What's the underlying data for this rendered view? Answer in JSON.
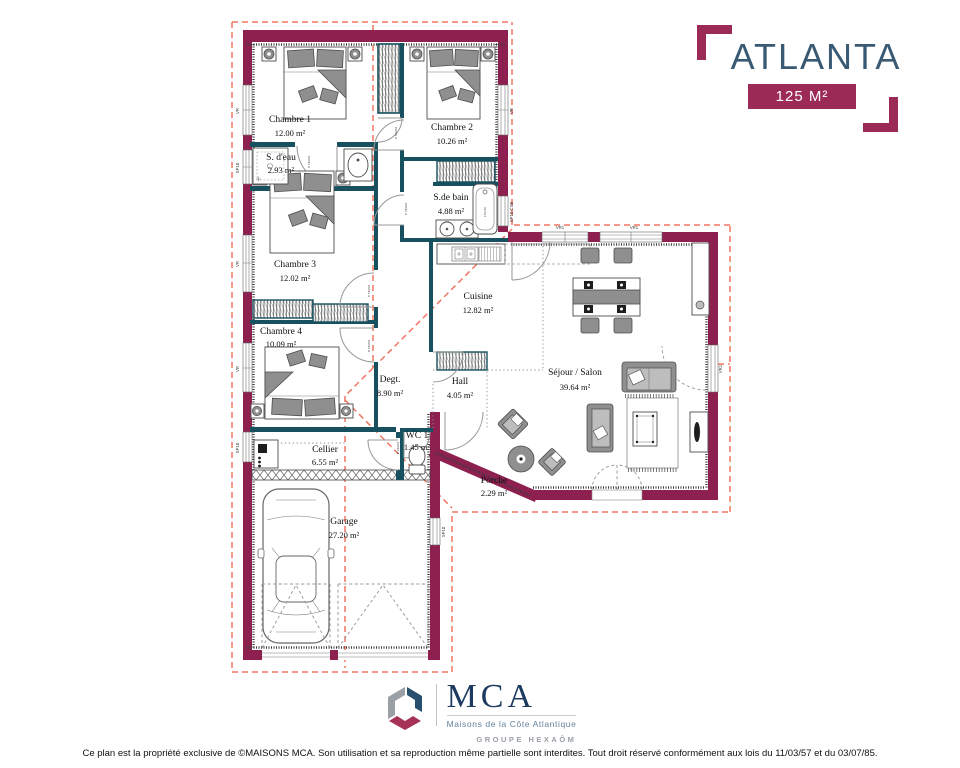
{
  "header": {
    "title": "ATLANTA",
    "area_badge": "125 M²"
  },
  "rooms": [
    {
      "name": "Chambre 1",
      "area": "12.00 m²"
    },
    {
      "name": "Chambre 2",
      "area": "10.26 m²"
    },
    {
      "name": "S. d'eau",
      "area": "2.93 m²"
    },
    {
      "name": "S.de bain",
      "area": "4.88 m²"
    },
    {
      "name": "Chambre 3",
      "area": "12.02 m²"
    },
    {
      "name": "Chambre 4",
      "area": "10.09 m²"
    },
    {
      "name": "Cuisine",
      "area": "12.82 m²"
    },
    {
      "name": "Séjour / Salon",
      "area": "39.64 m²"
    },
    {
      "name": "Degt.",
      "area": "8.90 m²"
    },
    {
      "name": "Hall",
      "area": "4.05 m²"
    },
    {
      "name": "WC 1",
      "area": "1.45 m²"
    },
    {
      "name": "Cellier",
      "area": "6.55 m²"
    },
    {
      "name": "Porche",
      "area": "2.29 m²"
    },
    {
      "name": "Garage",
      "area": "27.20 m²"
    }
  ],
  "labels": {
    "door": "P 73/204",
    "tub": "170x70",
    "vr": "VR",
    "vr1": "VR1",
    "sp10": "SP10",
    "sp10_csb": "SP10 CSB"
  },
  "footer": {
    "brand": "MCA",
    "tagline": "Maisons de la Côte Atlantique",
    "group": "GROUPE HEXAÔM"
  },
  "copyright": {
    "text": "Ce plan est la propriété exclusive de ©MAISONS MCA. Son utilisation et sa reproduction même partielle sont interdites. Tout droit réservé conformément aux lois du 11/03/57 et du 03/07/85."
  },
  "colors": {
    "wall": "#8e2050",
    "accent": "#9b2b56",
    "interior_wall": "#17505f",
    "roof_dash": "#f07663",
    "title_blue": "#3a5a74",
    "brand_navy": "#1d3a60"
  }
}
